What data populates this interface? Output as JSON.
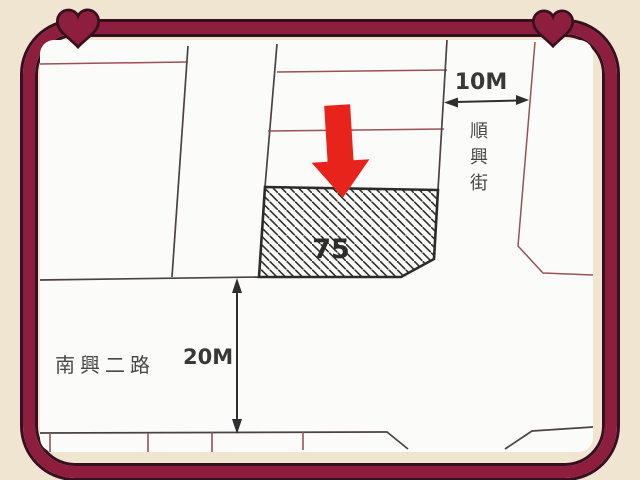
{
  "colors": {
    "page_bg": "#f0e5d1",
    "frame": "#8e1e3d",
    "frame_outline": "#37101e",
    "paper": "#fbfbf9",
    "line_dark": "#4a4343",
    "line_red": "#9a5156",
    "arrow_red": "#e8231c"
  },
  "map": {
    "parcel": {
      "number": "75"
    },
    "streets": {
      "vertical_street": "順興街",
      "horizontal_road": "南興二路"
    },
    "dimensions": {
      "street_width": "10M",
      "road_width": "20M"
    }
  },
  "icons": {
    "corner_decoration": "heart-icon",
    "highlight": "red-down-arrow-icon"
  }
}
